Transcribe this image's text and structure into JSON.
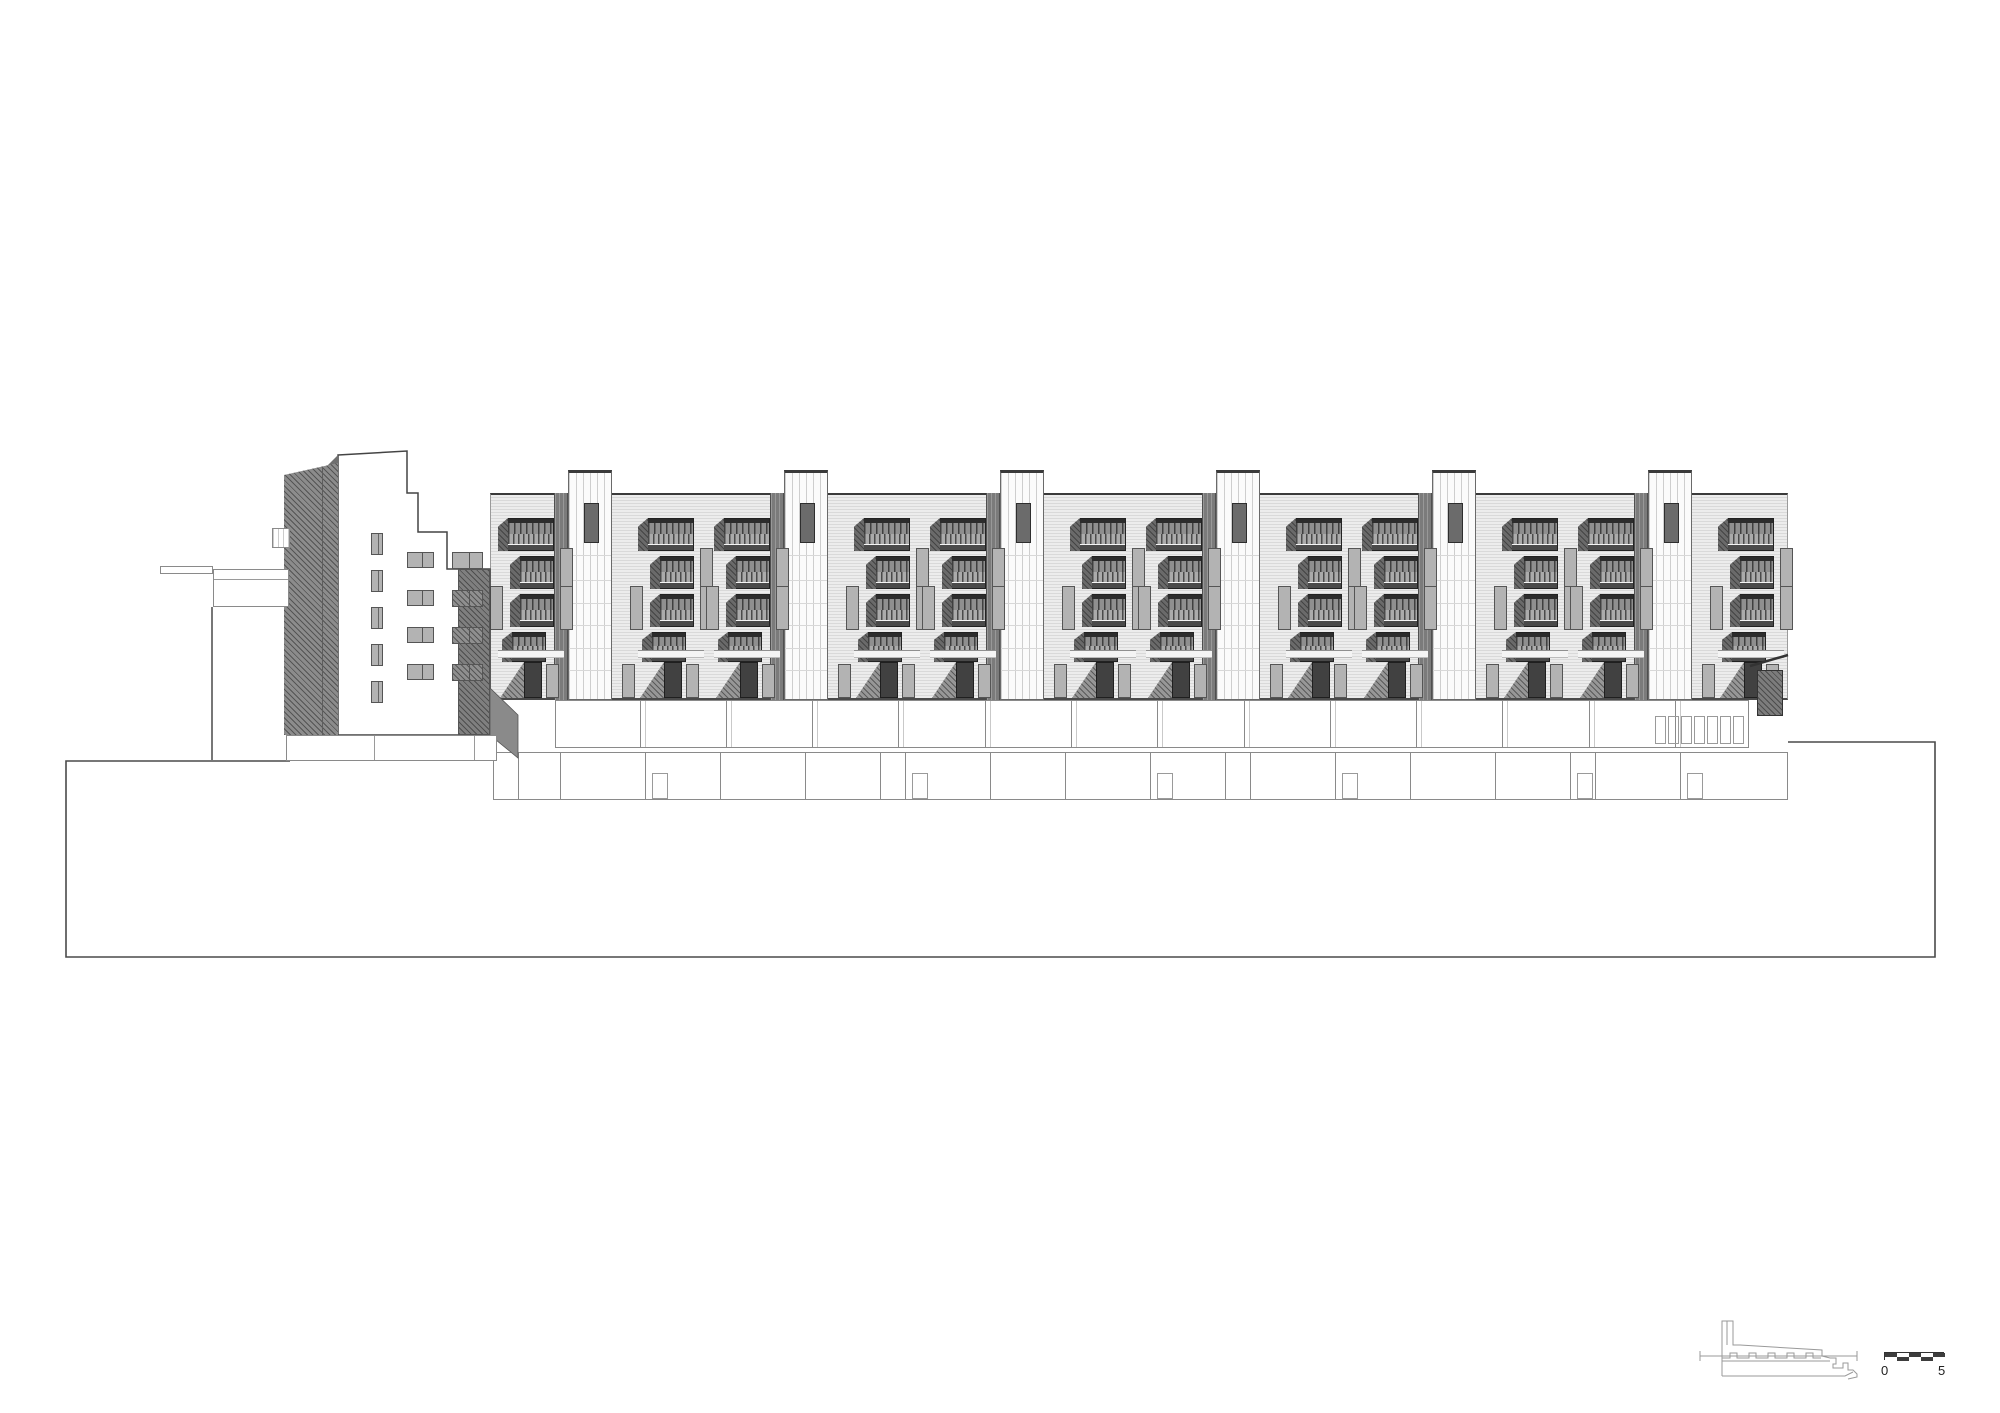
{
  "drawing": {
    "kind": "architectural building elevation (housing block, long facade with stair towers and stacked balconies)",
    "visible_text": [
      "0",
      "5"
    ],
    "colors": {
      "paper": "#ffffff",
      "line_dark": "#3a3a3a",
      "cladding_light": "#ececec",
      "cladding_stripe": "#d9d9d9",
      "tower_white": "#fbfbfb",
      "party_wall_gray": "#7b7b7b",
      "balcony_dark": "#3f3f3f",
      "balcony_rail": "#ababab",
      "shadow_mass": "#8c8c8c",
      "slot_gray": "#b3b3b3"
    }
  },
  "elevation": {
    "canvas": {
      "w": 2000,
      "h": 1413
    },
    "terrain": {
      "left_x": 66,
      "left_top_y": 761,
      "mid_step_x": 1000,
      "right_top_y": 742,
      "right_x": 1935,
      "bottom_y": 957,
      "left_top_run_to": 290
    },
    "facade": {
      "x": 490,
      "right": 1788,
      "roof_y": 493,
      "base_y": 700,
      "units": 6,
      "unit_w": 216,
      "origin": 508,
      "tower": {
        "dx": 60,
        "w": 44,
        "top_y": 470,
        "win": {
          "dy": 30,
          "w": 15,
          "h": 40
        },
        "hlines": [
          82,
          107,
          130,
          152,
          175,
          197
        ]
      },
      "strip": {
        "dx": 46,
        "w": 14
      },
      "stack": {
        "right_dx": 0,
        "mid_dx": 140,
        "w": 46,
        "floors": [
          518,
          556,
          594,
          632
        ],
        "fl_h": [
          33,
          33,
          33,
          30
        ],
        "fl_xoff": [
          0,
          12,
          12,
          4
        ],
        "fl_w": [
          46,
          34,
          34,
          34
        ]
      },
      "ground": {
        "band_y": 650,
        "door_y": 662,
        "door_w": 18,
        "door_h": 36,
        "slot_y": 664,
        "slot_h": 34
      }
    },
    "podium_upper": {
      "y": 700,
      "h": 48,
      "edges": [
        555,
        640,
        726,
        812,
        898,
        985,
        1071,
        1157,
        1244,
        1330,
        1416,
        1502,
        1589,
        1675,
        1748
      ],
      "slats_x0": 1655,
      "slats_x1": 1740,
      "slat_y": 716,
      "slat_h": 28
    },
    "podium_lower": {
      "y": 752,
      "h": 48,
      "edges": [
        493,
        518,
        560,
        645,
        720,
        805,
        880,
        905,
        990,
        1065,
        1150,
        1225,
        1250,
        1335,
        1410,
        1495,
        1570,
        1595,
        1680,
        1787
      ],
      "door_boxes": [
        3,
        7,
        10,
        13,
        16,
        18
      ]
    },
    "left_building": {
      "outline": [
        [
          338,
          455
        ],
        [
          407,
          451
        ],
        [
          407,
          493
        ],
        [
          418,
          493
        ],
        [
          418,
          532
        ],
        [
          447,
          532
        ],
        [
          447,
          569
        ],
        [
          490,
          569
        ],
        [
          490,
          735
        ],
        [
          338,
          735
        ]
      ],
      "dark_mass": {
        "x": 284,
        "y": 463,
        "w": 54,
        "h": 272
      },
      "dark_block": {
        "x": 458,
        "y": 569,
        "w": 32,
        "h": 166
      },
      "plinth": {
        "x": 286,
        "y": 735,
        "w": 211,
        "h": 26,
        "vlines": [
          373,
          473
        ]
      },
      "bridge": {
        "x": 160,
        "y": 566,
        "w": 53,
        "h": 8
      },
      "wing": {
        "x": 213,
        "y": 569,
        "w": 76,
        "h": 38,
        "inner_y": 578,
        "support_x": 211,
        "support_y2": 761
      },
      "knob": {
        "x": 272,
        "y": 528,
        "w": 18,
        "h": 20
      },
      "small_win_col": {
        "x": 371,
        "w": 12,
        "h": 22,
        "ys": [
          533,
          570,
          607,
          644,
          681
        ]
      },
      "pair_win_colA": {
        "x": 407,
        "w": 27,
        "h": 16,
        "ys": [
          552,
          590,
          627,
          664
        ]
      },
      "pair_win_colB": {
        "x": 452,
        "w": 31,
        "h": 17,
        "ys": [
          552,
          590,
          627,
          664
        ]
      },
      "stair_wedge": [
        [
          490,
          688
        ],
        [
          518,
          715
        ],
        [
          518,
          758
        ],
        [
          490,
          735
        ]
      ]
    },
    "right_end": {
      "canopy": [
        [
          1750,
          666
        ],
        [
          1788,
          655
        ]
      ],
      "hatch_box": {
        "x": 1757,
        "y": 670,
        "w": 26,
        "h": 46
      }
    },
    "key_plan": {
      "x": 1698,
      "y": 1318,
      "w": 165,
      "h": 62
    },
    "scale_bar": {
      "x": 1884,
      "y": 1352,
      "seg_w": 12,
      "seg_h": 4,
      "segments": 5,
      "label_left": "0",
      "label_right": "5"
    }
  }
}
